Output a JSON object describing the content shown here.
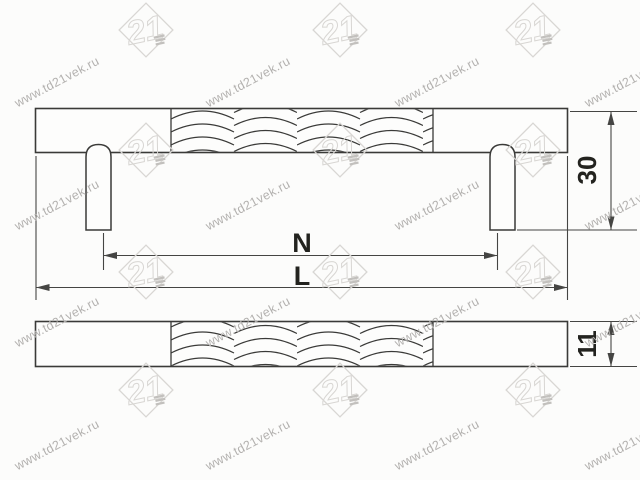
{
  "drawing": {
    "title": "furniture-handle-technical-drawing",
    "labels": {
      "hole_span": "N",
      "total_length": "L",
      "height": "30",
      "bar_thickness": "11"
    }
  },
  "watermark": {
    "text": "www.td21vek.ru",
    "logo_text": "21",
    "text_color": "#b3b1af",
    "logo_color": "#d8d6d3",
    "logo_accent_color": "#c2c0bd",
    "text_positions": {
      "xs": [
        57,
        248,
        437,
        627
      ],
      "ys": [
        82,
        205,
        322,
        445
      ],
      "angle_deg": -28
    },
    "logo_positions": {
      "xs": [
        146,
        340,
        533
      ],
      "ys": [
        30,
        150,
        272,
        390
      ]
    }
  },
  "colors": {
    "background": "#fcfcfb",
    "line": "#3a3a38",
    "dim_line": "#454543",
    "label": "#23231f"
  }
}
